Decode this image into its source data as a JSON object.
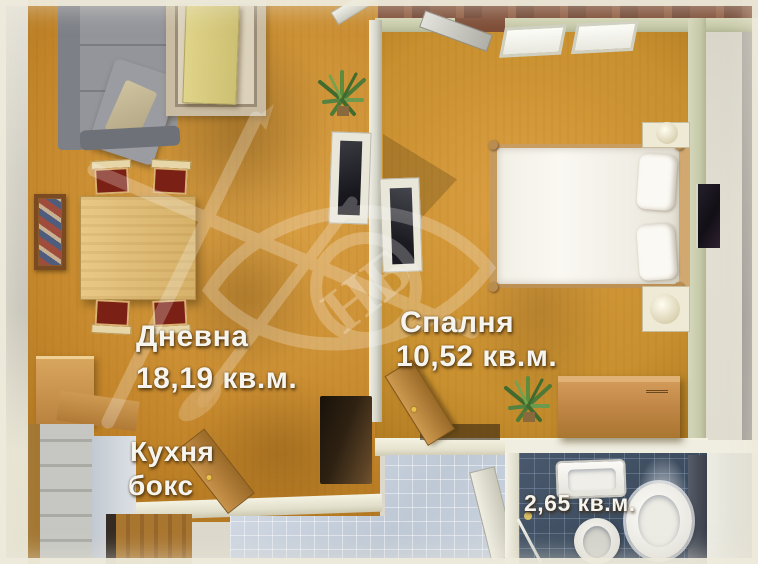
{
  "rooms": {
    "living": {
      "name": "Дневна",
      "area": "18,19 кв.м."
    },
    "kitchen": {
      "line1": "Кухня",
      "line2": "бокс"
    },
    "bedroom": {
      "name": "Спалня",
      "area": "10,52 кв.м."
    },
    "bathroom": {
      "area": "2,65 кв.м."
    }
  },
  "watermark": {
    "monogram": "НБ"
  },
  "colors": {
    "labelText": "#F6F4EE",
    "floorLiving": "#C4862A",
    "floorBedroom": "#C8902F",
    "wallGreen": "#C6C9A8",
    "wallCream": "#EDEBD8",
    "brick": "#7D4C36",
    "bathTile": "#3E4E60",
    "hallTile": "#C9D2DD",
    "sofaGray": "#93959B",
    "doorWood": "#B9813E"
  }
}
